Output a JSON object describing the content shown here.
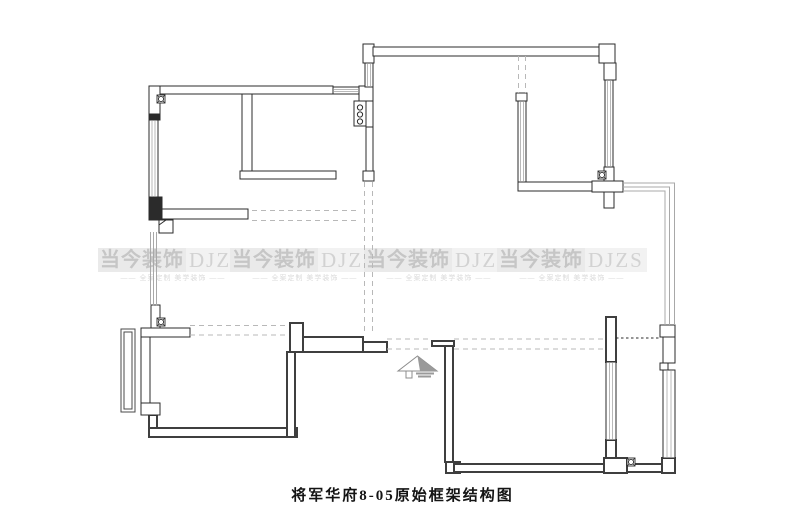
{
  "canvas": {
    "width": 805,
    "height": 532,
    "background": "#ffffff"
  },
  "caption": {
    "text": "将军华府8-05原始框架结构图"
  },
  "watermark": {
    "brand_cn": "当今装饰",
    "brand_en": "DJZS",
    "tagline": "—— 全案定制 美学装饰 ——",
    "instances": [
      {
        "x": 98,
        "y": 248
      },
      {
        "x": 230,
        "y": 248
      },
      {
        "x": 364,
        "y": 248
      },
      {
        "x": 497,
        "y": 248
      }
    ]
  },
  "plan": {
    "colors": {
      "wall_stroke": "#2b2b2b",
      "dark_wall_stroke": "#3f3f3f",
      "wall_fill": "#ffffff",
      "window_inner": "#b9b9b9",
      "railing": "#a8a8a8",
      "dash": "#b8b8b8",
      "dot": "#2b2b2b",
      "bay_frame": "#4a4a4a",
      "arrow": "#8c8c8c",
      "arrow_fill": "#9a9a9a"
    },
    "walls_outline": [
      {
        "x": 152,
        "y": 86,
        "w": 181,
        "h": 8
      },
      {
        "x": 149,
        "y": 86,
        "w": 11,
        "h": 34
      },
      {
        "x": 162,
        "y": 209,
        "w": 86,
        "h": 10
      },
      {
        "x": 242,
        "y": 94,
        "w": 10,
        "h": 77
      },
      {
        "x": 240,
        "y": 171,
        "w": 96,
        "h": 8
      },
      {
        "x": 359,
        "y": 86,
        "w": 14,
        "h": 15
      },
      {
        "x": 354,
        "y": 101,
        "w": 12,
        "h": 25
      },
      {
        "x": 366,
        "y": 101,
        "w": 7,
        "h": 26
      },
      {
        "x": 366,
        "y": 127,
        "w": 7,
        "h": 44
      },
      {
        "x": 363,
        "y": 171,
        "w": 11,
        "h": 10
      },
      {
        "x": 363,
        "y": 44,
        "w": 11,
        "h": 19
      },
      {
        "x": 373,
        "y": 47,
        "w": 226,
        "h": 9
      },
      {
        "x": 599,
        "y": 44,
        "w": 16,
        "h": 19
      },
      {
        "x": 604,
        "y": 63,
        "w": 12,
        "h": 17
      },
      {
        "x": 516,
        "y": 93,
        "w": 11,
        "h": 8
      },
      {
        "x": 518,
        "y": 182,
        "w": 74,
        "h": 9
      },
      {
        "x": 604,
        "y": 167,
        "w": 10,
        "h": 41
      },
      {
        "x": 592,
        "y": 181,
        "w": 31,
        "h": 11
      },
      {
        "x": 151,
        "y": 305,
        "w": 9,
        "h": 23
      },
      {
        "x": 141,
        "y": 328,
        "w": 49,
        "h": 9
      },
      {
        "x": 141,
        "y": 337,
        "w": 9,
        "h": 66
      },
      {
        "x": 141,
        "y": 403,
        "w": 19,
        "h": 12
      },
      {
        "x": 159,
        "y": 220,
        "w": 14,
        "h": 13
      },
      {
        "x": 660,
        "y": 325,
        "w": 15,
        "h": 12
      },
      {
        "x": 663,
        "y": 337,
        "w": 12,
        "h": 26
      },
      {
        "x": 660,
        "y": 363,
        "w": 8,
        "h": 7
      }
    ],
    "walls_dark": [
      {
        "x": 290,
        "y": 323,
        "w": 13,
        "h": 29
      },
      {
        "x": 303,
        "y": 337,
        "w": 60,
        "h": 15
      },
      {
        "x": 363,
        "y": 342,
        "w": 24,
        "h": 10
      },
      {
        "x": 432,
        "y": 341,
        "w": 22,
        "h": 5
      },
      {
        "x": 445,
        "y": 346,
        "w": 8,
        "h": 116
      },
      {
        "x": 446,
        "y": 462,
        "w": 14,
        "h": 11
      },
      {
        "x": 454,
        "y": 464,
        "w": 208,
        "h": 8
      },
      {
        "x": 662,
        "y": 458,
        "w": 13,
        "h": 15
      },
      {
        "x": 606,
        "y": 317,
        "w": 10,
        "h": 45
      },
      {
        "x": 606,
        "y": 440,
        "w": 10,
        "h": 18
      },
      {
        "x": 604,
        "y": 458,
        "w": 23,
        "h": 15
      },
      {
        "x": 149,
        "y": 415,
        "w": 8,
        "h": 15
      },
      {
        "x": 149,
        "y": 428,
        "w": 148,
        "h": 9
      },
      {
        "x": 287,
        "y": 352,
        "w": 8,
        "h": 85
      }
    ],
    "walls_filled": [
      {
        "x": 149,
        "y": 114,
        "w": 11,
        "h": 6
      },
      {
        "x": 149,
        "y": 197,
        "w": 13,
        "h": 23
      }
    ],
    "windows": [
      {
        "x": 149,
        "y": 120,
        "w": 9,
        "h": 77,
        "o": "v"
      },
      {
        "x": 333,
        "y": 87,
        "w": 26,
        "h": 7,
        "o": "h"
      },
      {
        "x": 365,
        "y": 63,
        "w": 8,
        "h": 24,
        "o": "v"
      },
      {
        "x": 605,
        "y": 80,
        "w": 8,
        "h": 87,
        "o": "v"
      },
      {
        "x": 518,
        "y": 101,
        "w": 8,
        "h": 81,
        "o": "v"
      },
      {
        "x": 606,
        "y": 362,
        "w": 10,
        "h": 78,
        "o": "v"
      },
      {
        "x": 663,
        "y": 370,
        "w": 12,
        "h": 88,
        "o": "v"
      }
    ],
    "left_wall_lines": {
      "xs": [
        150.5,
        153.5,
        156.5
      ],
      "y1": 232,
      "y2": 306
    },
    "railing_polylines": [
      [
        [
          623,
          183
        ],
        [
          674.5,
          183
        ],
        [
          674.5,
          325
        ]
      ],
      [
        [
          623,
          187
        ],
        [
          669.5,
          187
        ],
        [
          669.5,
          325
        ]
      ],
      [
        [
          623,
          191
        ],
        [
          665,
          191
        ],
        [
          665,
          325
        ]
      ]
    ],
    "bay_window": [
      {
        "x": 121,
        "y": 329,
        "w": 14,
        "h": 83
      },
      {
        "x": 124,
        "y": 332,
        "w": 8,
        "h": 77
      }
    ],
    "dashed_lines": [
      {
        "x1": 252,
        "y1": 210.5,
        "x2": 360,
        "y2": 210.5
      },
      {
        "x1": 252,
        "y1": 220.5,
        "x2": 360,
        "y2": 220.5
      },
      {
        "x1": 364.5,
        "y1": 182,
        "x2": 364.5,
        "y2": 333
      },
      {
        "x1": 372.5,
        "y1": 182,
        "x2": 372.5,
        "y2": 333
      },
      {
        "x1": 518.5,
        "y1": 56,
        "x2": 518.5,
        "y2": 93
      },
      {
        "x1": 525.5,
        "y1": 56,
        "x2": 525.5,
        "y2": 93
      },
      {
        "x1": 190,
        "y1": 325.5,
        "x2": 287,
        "y2": 325.5
      },
      {
        "x1": 190,
        "y1": 335,
        "x2": 287,
        "y2": 335
      },
      {
        "x1": 387,
        "y1": 339,
        "x2": 432,
        "y2": 339
      },
      {
        "x1": 454,
        "y1": 339,
        "x2": 604,
        "y2": 339
      },
      {
        "x1": 387,
        "y1": 349,
        "x2": 432,
        "y2": 349
      },
      {
        "x1": 454,
        "y1": 349,
        "x2": 604,
        "y2": 349
      }
    ],
    "dotted_lines": [
      {
        "x1": 616,
        "y1": 338,
        "x2": 660,
        "y2": 338
      }
    ],
    "flue_symbols": [
      {
        "x": 157,
        "y": 95
      },
      {
        "x": 598,
        "y": 171
      },
      {
        "x": 157,
        "y": 318
      },
      {
        "x": 627,
        "y": 458
      }
    ],
    "distribution_box_circles": [
      {
        "cx": 360,
        "cy": 107.5
      },
      {
        "cx": 360,
        "cy": 114.5
      },
      {
        "cx": 360,
        "cy": 121.5
      }
    ],
    "step_detail": {
      "line": [
        159,
        225,
        166,
        220
      ]
    },
    "entry_arrow": {
      "roof": [
        [
          398,
          371
        ],
        [
          417.5,
          356
        ],
        [
          437,
          371
        ]
      ],
      "shade": [
        [
          417.5,
          356
        ],
        [
          437,
          371
        ],
        [
          420,
          371
        ]
      ],
      "notch": {
        "x": 406,
        "y": 371,
        "w": 6,
        "h": 7
      },
      "stripes": [
        {
          "x1": 416,
          "y1": 373.5,
          "x2": 434,
          "y2": 373.5
        },
        {
          "x1": 418,
          "y1": 376.5,
          "x2": 431,
          "y2": 376.5
        }
      ]
    }
  }
}
